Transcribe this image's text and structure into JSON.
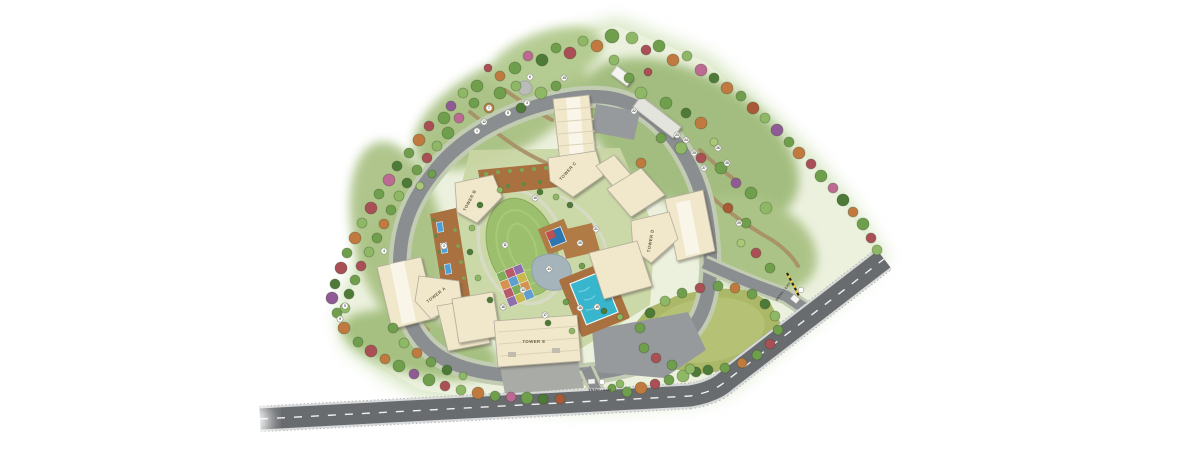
{
  "plan": {
    "towers": [
      {
        "id": "tower-a",
        "label": "TOWER A"
      },
      {
        "id": "tower-b",
        "label": "TOWER B"
      },
      {
        "id": "tower-c",
        "label": "TOWER C"
      },
      {
        "id": "tower-d",
        "label": "TOWER D"
      },
      {
        "id": "tower-e",
        "label": "TOWER E"
      }
    ],
    "gates": {
      "south_label": "ENTRY / EXIT",
      "east_label": "ENTRY / EXIT"
    },
    "markers": [
      {
        "n": "1",
        "x": 477,
        "y": 131
      },
      {
        "n": "2",
        "x": 444,
        "y": 246
      },
      {
        "n": "3",
        "x": 527,
        "y": 103
      },
      {
        "n": "4",
        "x": 384,
        "y": 251
      },
      {
        "n": "5",
        "x": 345,
        "y": 306
      },
      {
        "n": "6",
        "x": 530,
        "y": 77
      },
      {
        "n": "7",
        "x": 489,
        "y": 108
      },
      {
        "n": "8",
        "x": 508,
        "y": 113
      },
      {
        "n": "9",
        "x": 340,
        "y": 319
      },
      {
        "n": "10",
        "x": 535,
        "y": 198
      },
      {
        "n": "11",
        "x": 505,
        "y": 245
      },
      {
        "n": "12",
        "x": 484,
        "y": 122
      },
      {
        "n": "13",
        "x": 523,
        "y": 290
      },
      {
        "n": "14",
        "x": 549,
        "y": 269
      },
      {
        "n": "15",
        "x": 564,
        "y": 78
      },
      {
        "n": "16",
        "x": 503,
        "y": 307
      },
      {
        "n": "17",
        "x": 545,
        "y": 315
      },
      {
        "n": "18",
        "x": 580,
        "y": 308
      },
      {
        "n": "19",
        "x": 597,
        "y": 307
      },
      {
        "n": "20",
        "x": 580,
        "y": 243
      },
      {
        "n": "21",
        "x": 596,
        "y": 229
      },
      {
        "n": "22",
        "x": 634,
        "y": 111
      },
      {
        "n": "23",
        "x": 677,
        "y": 135
      },
      {
        "n": "24",
        "x": 686,
        "y": 140
      },
      {
        "n": "25",
        "x": 694,
        "y": 153
      },
      {
        "n": "26",
        "x": 718,
        "y": 148
      },
      {
        "n": "27",
        "x": 704,
        "y": 168
      },
      {
        "n": "28",
        "x": 727,
        "y": 163
      },
      {
        "n": "29",
        "x": 739,
        "y": 223
      }
    ],
    "palette": {
      "main_road": "#696c6f",
      "loop_road": "#8b8e91",
      "paver_band": "#c2ccb2",
      "building": "#f1e7ca",
      "pool": "#38b6ce",
      "central_lawn": "#9cbf6d",
      "side_lawn": "#aab868",
      "deck": "#a9713f",
      "glow_green": "#bcd69b"
    }
  }
}
